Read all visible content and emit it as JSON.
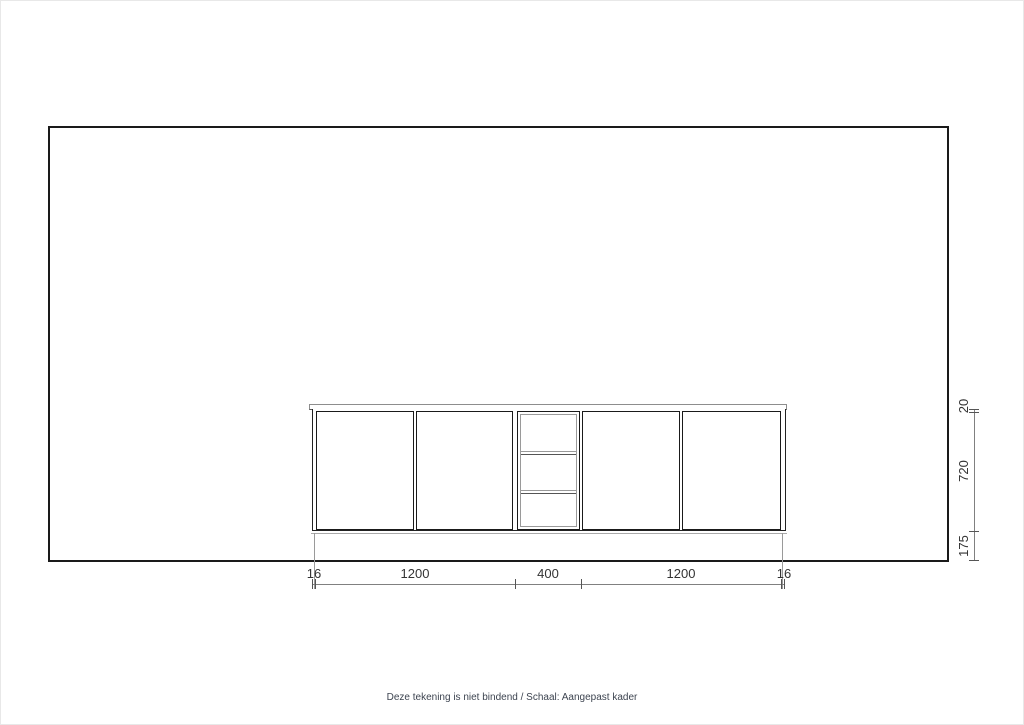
{
  "drawing": {
    "type": "kitchen-cabinet-elevation",
    "dims_h": {
      "left_panel": "16",
      "left_doors": "1200",
      "open_shelf": "400",
      "right_doors": "1200",
      "right_panel": "16"
    },
    "dims_v": {
      "worktop": "20",
      "carcass": "720",
      "plinth": "175"
    },
    "footer_note": "Deze tekening is niet bindend / Schaal: Aangepast kader"
  },
  "colors": {
    "outline": "#1a1a1a",
    "dim_line": "#808080",
    "dim_text": "#333333",
    "note_text": "#3d4450",
    "background": "#ffffff"
  }
}
